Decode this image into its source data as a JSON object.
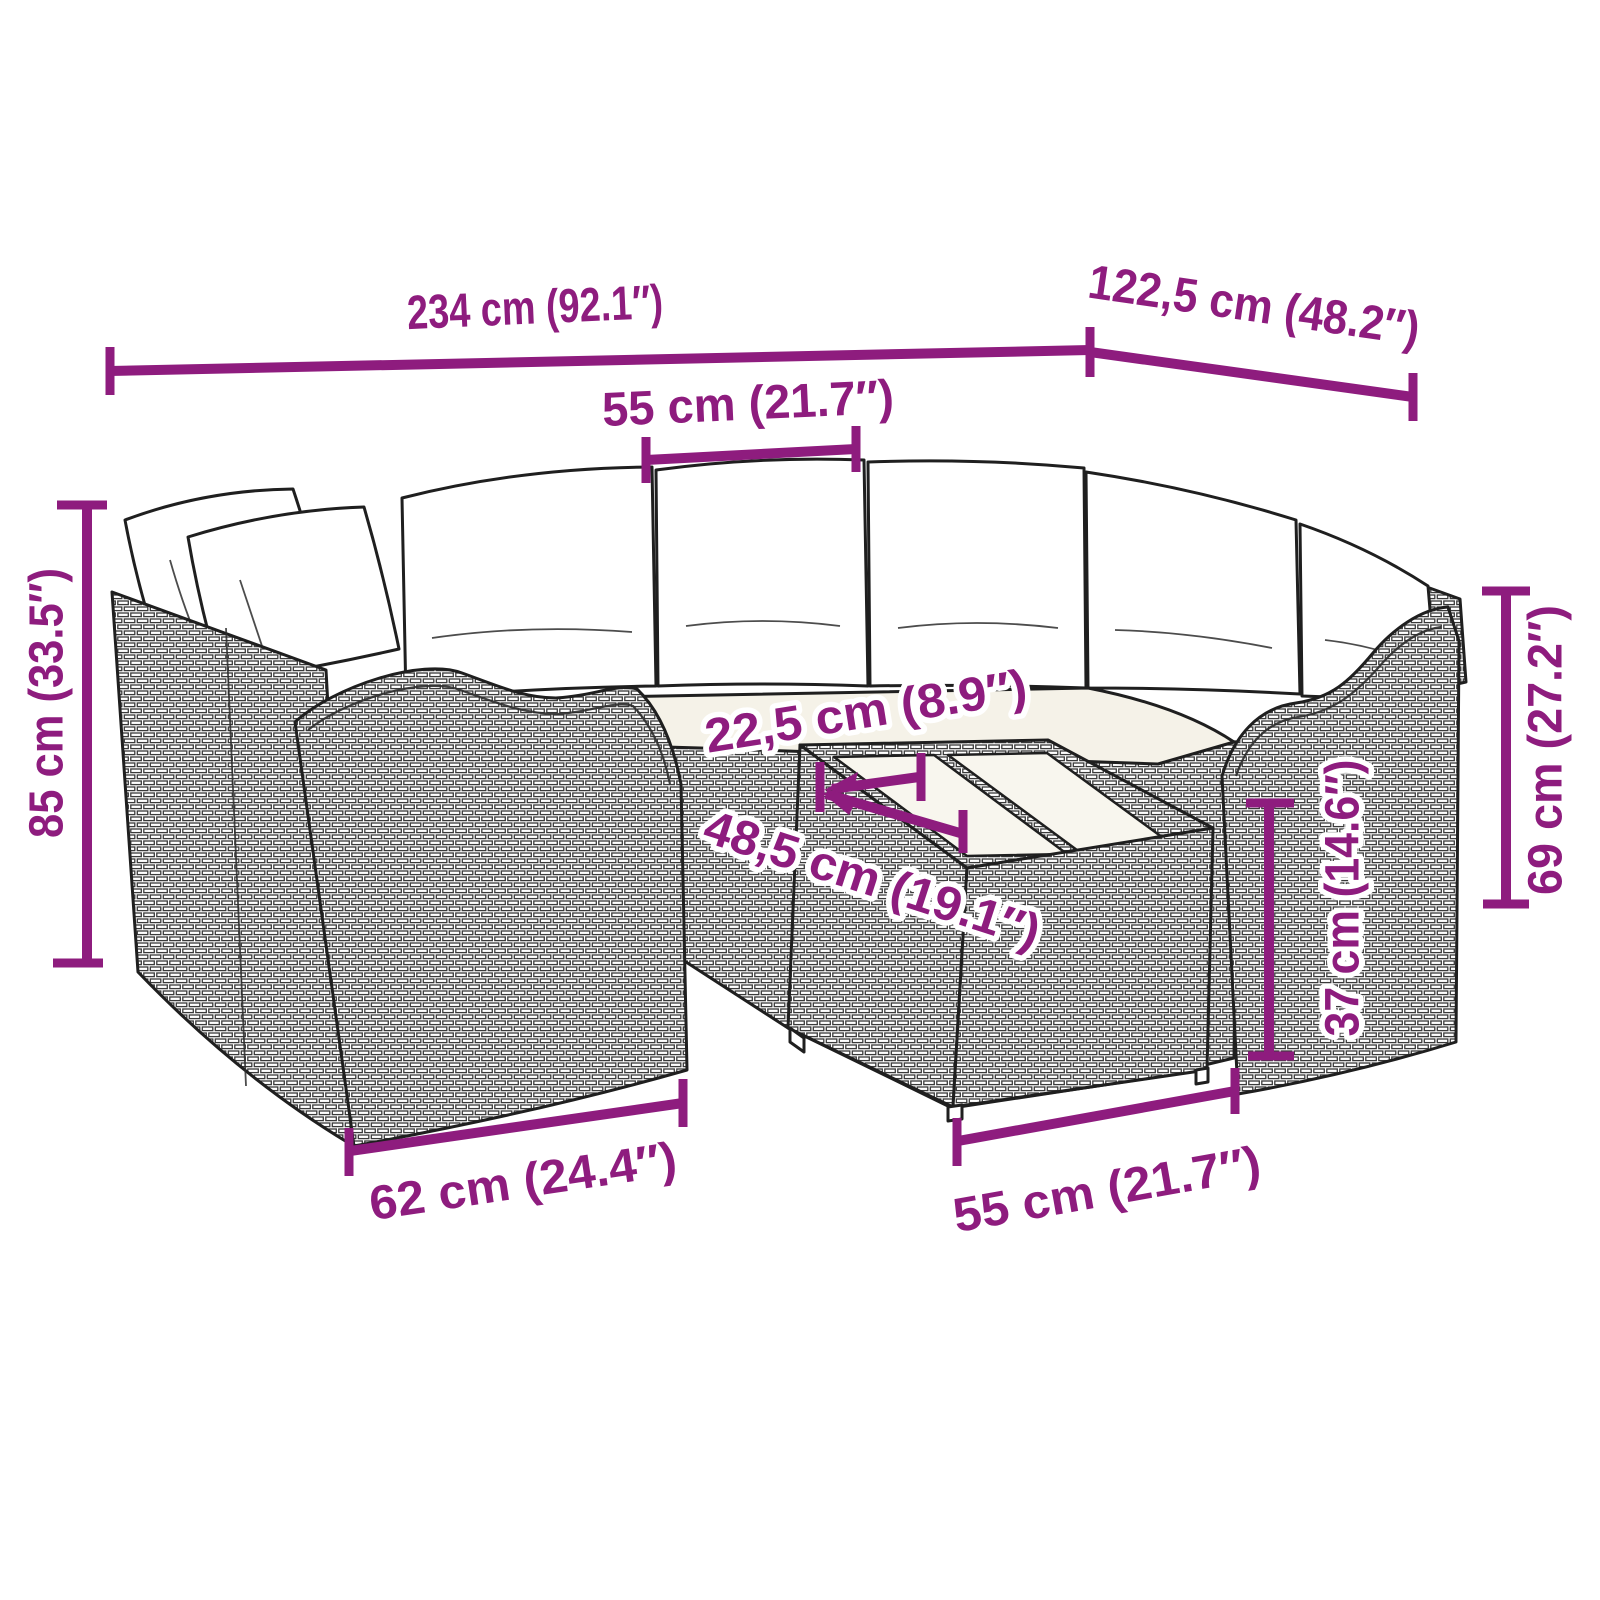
{
  "figure": {
    "kind": "product dimension diagram",
    "subject": "rattan garden corner sofa set with back cushions, seat cushions and a glass-top coffee table, drawn as black line art on white"
  },
  "colors": {
    "annotation": "#8E1C7E",
    "annotation_halo": "#ffffff",
    "line_art": "#1f1f1f",
    "background": "#ffffff",
    "cushion_fill": "#ffffff",
    "seat_fill": "#f5f2e8"
  },
  "dims": {
    "overall_width": "234 cm (92.1″)",
    "overall_depth": "122,5 cm (48.2″)",
    "back_cushion_width": "55 cm (21.7″)",
    "overall_height": "85 cm (33.5″)",
    "seat_table_offset": "22,5 cm (8.9″)",
    "table_top_depth": "48,5 cm (19.1″)",
    "arm_height": "69 cm (27.2″)",
    "table_height": "37 cm (14.6″)",
    "side_panel_depth": "62 cm (24.4″)",
    "table_width": "55 cm (21.7″)"
  }
}
